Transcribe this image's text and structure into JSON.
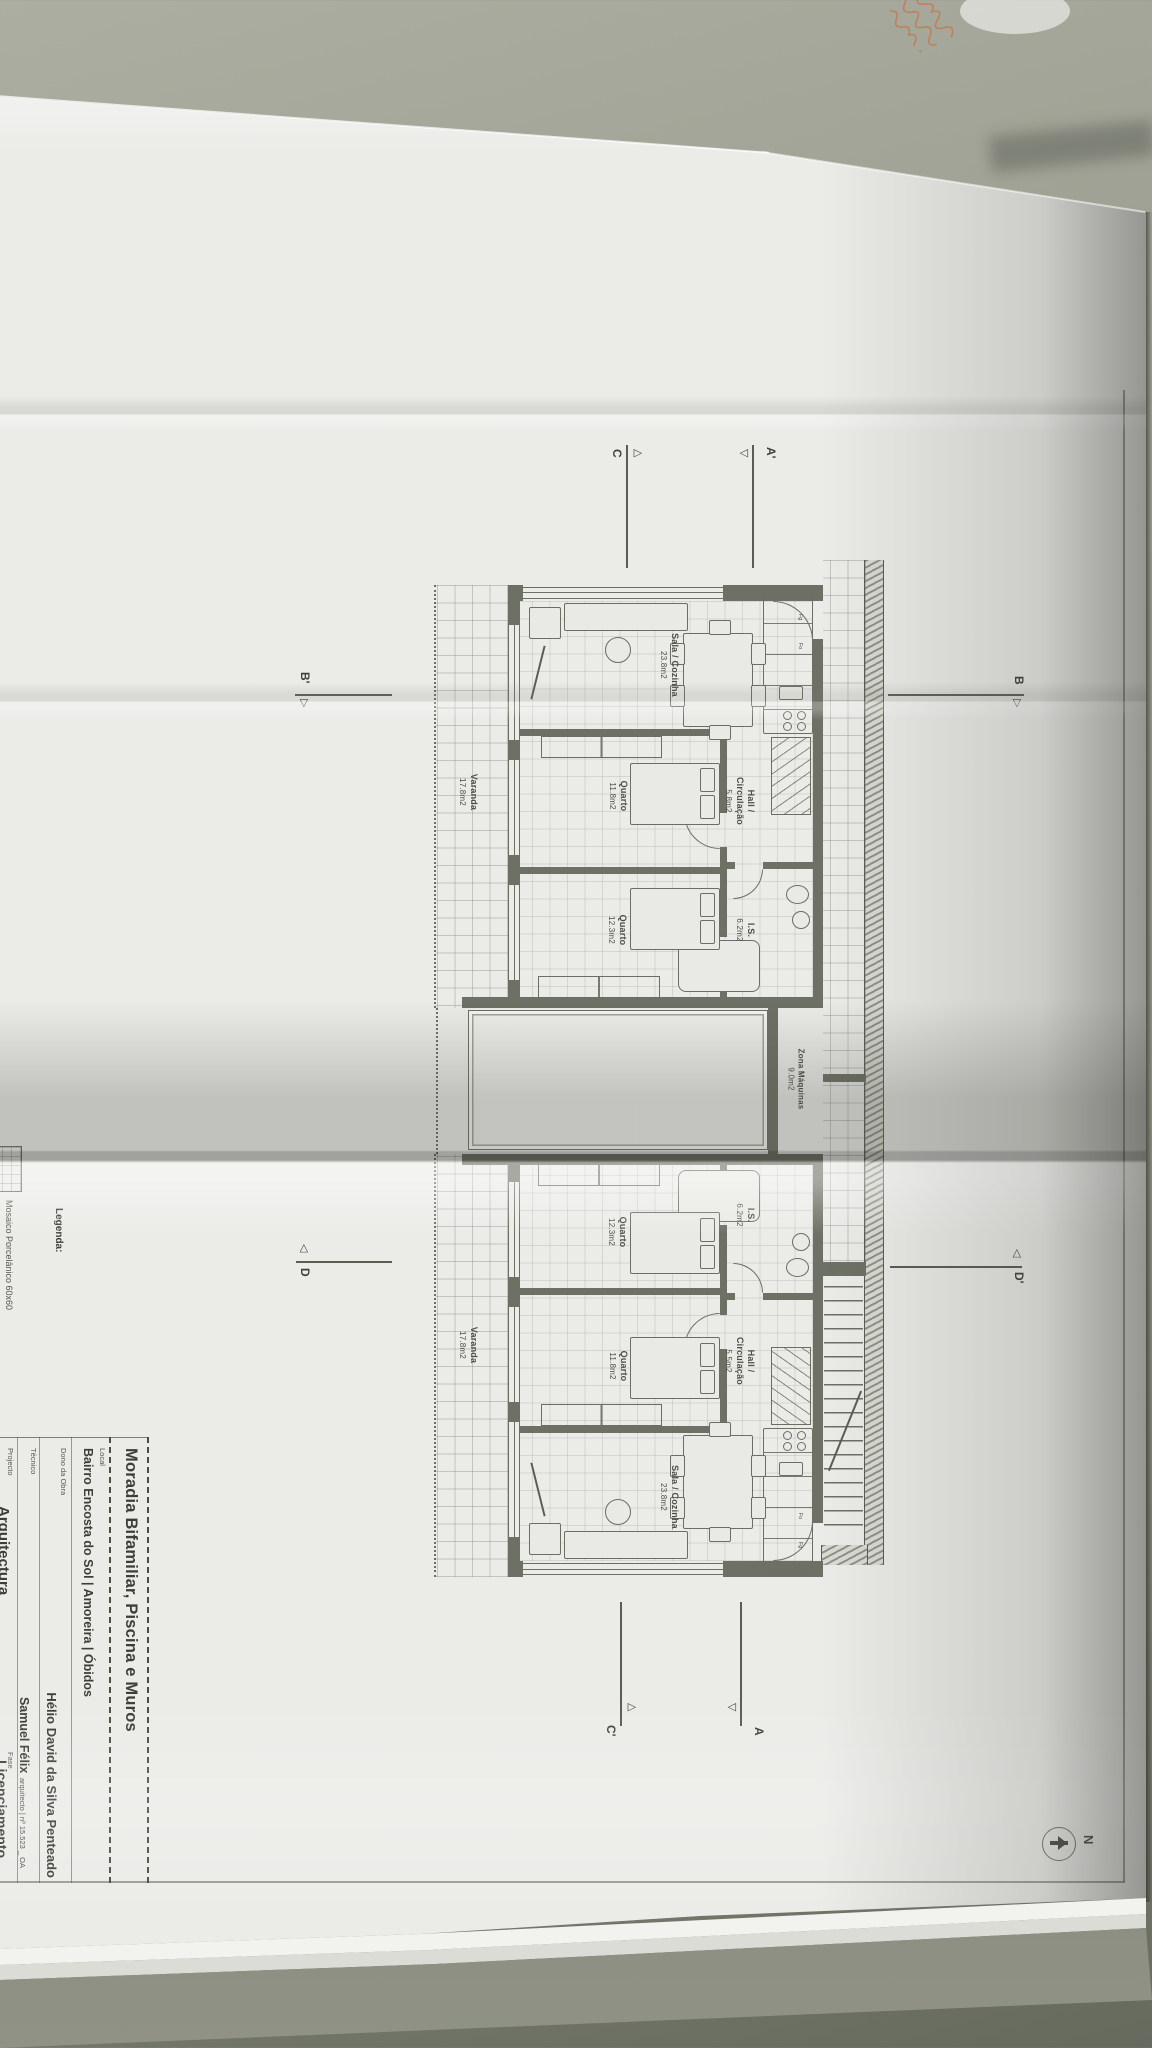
{
  "scene": {
    "description": "Photo of a folded architectural floor-plan sheet lying on a grey-green table, drawing rotated 90 degrees, with an envelope with orange handwriting at top right",
    "colors": {
      "table": "#9b9e90",
      "paper": "#ebebe8",
      "ink": "#5a5d52",
      "handwriting": "#c8794e"
    }
  },
  "title_block": {
    "title": "Moradia Bifamiliar, Piscina e Muros",
    "local": {
      "label": "Local",
      "value": "Bairro Encosta do Sol | Amoreira | Óbidos"
    },
    "dono": {
      "label": "Dono da Obra",
      "value": "Hélio David da Silva Penteado"
    },
    "tecnico": {
      "label": "Técnico",
      "value": "Samuel Félix",
      "suffix": "arquitecto | nº 15.523 _ OA"
    },
    "projecto": {
      "label": "Projecto",
      "value": "Arquitectura"
    },
    "fase": {
      "label": "Fase",
      "value": "Licenciamento"
    }
  },
  "legend": {
    "heading": "Legenda:",
    "item": "Mosaico Porcelânico 60x60"
  },
  "plan": {
    "unit_a": {
      "rooms": {
        "sala": {
          "name": "Sala / Cozinha",
          "area": "23.8m2"
        },
        "hall": {
          "name": "Hall / Circulação",
          "area": "5.8m2"
        },
        "quarto1": {
          "name": "Quarto",
          "area": "11.8m2"
        },
        "quarto2": {
          "name": "Quarto",
          "area": "12.3m2"
        },
        "is": {
          "name": "I.S.",
          "area": "6.2m2"
        },
        "varanda": {
          "name": "Varanda",
          "area": "17.8m2"
        }
      }
    },
    "unit_b": {
      "rooms": {
        "sala": {
          "name": "Sala / Cozinha",
          "area": "23.8m2"
        },
        "hall": {
          "name": "Hall / Circulação",
          "area": "5.5m2"
        },
        "quarto1": {
          "name": "Quarto",
          "area": "11.8m2"
        },
        "quarto2": {
          "name": "Quarto",
          "area": "12.3m2"
        },
        "is": {
          "name": "I.S.",
          "area": "6.2m2"
        },
        "varanda": {
          "name": "Varanda",
          "area": "17.8m2"
        }
      }
    },
    "zona": {
      "name": "Zona Máquinas",
      "area": "9.0m2"
    },
    "markers": {
      "a": "A",
      "a_prime": "A'",
      "b": "B",
      "b_prime": "B'",
      "c": "C",
      "c_prime": "C'",
      "d": "D",
      "d_prime": "D'"
    },
    "north": "N",
    "kitchen": {
      "fridge": "Fg",
      "oven": "Fo"
    }
  }
}
